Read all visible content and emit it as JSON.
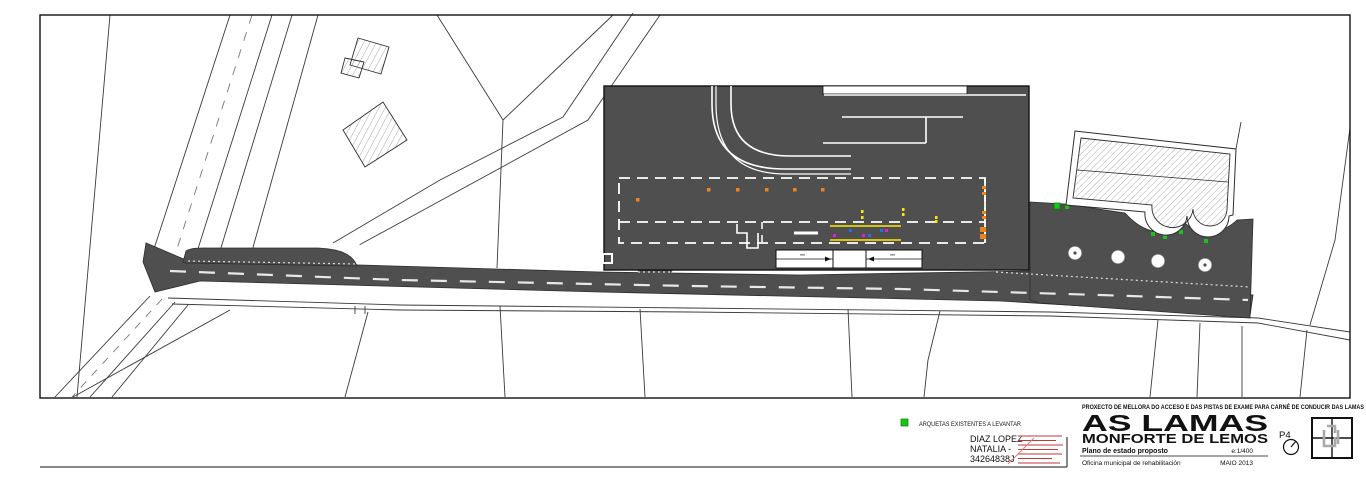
{
  "sheet": {
    "legend": {
      "arquetas_label": "ARQUETAS EXISTENTES A LEVANTAR"
    },
    "signature": {
      "name_line1": "DIAZ LOPEZ",
      "name_line2": "NATALIA -",
      "name_line3": "34264838J"
    },
    "title_block": {
      "project_line": "PROXECTO DE MELLORA DO ACCESO E DAS PISTAS DE EXAME PARA CARNÉ DE CONDUCIR DAS LAMAS",
      "place": "AS LAMAS",
      "municipality": "MONFORTE DE LEMOS",
      "sheet_number": "P4",
      "plan_title": "Plano de estado proposto",
      "scale": "e:1/400",
      "office": "Oficina municipal de rehabilitación",
      "date": "MAIO 2013"
    },
    "colors": {
      "paving": "#4f4f4f",
      "marking_white": "#e8e8e8",
      "orange": "#f08418",
      "yellow": "#ffe800",
      "green": "#17c517",
      "magenta": "#e020e0",
      "blue": "#2b6bf2",
      "signature_red": "#c03a3a"
    }
  }
}
